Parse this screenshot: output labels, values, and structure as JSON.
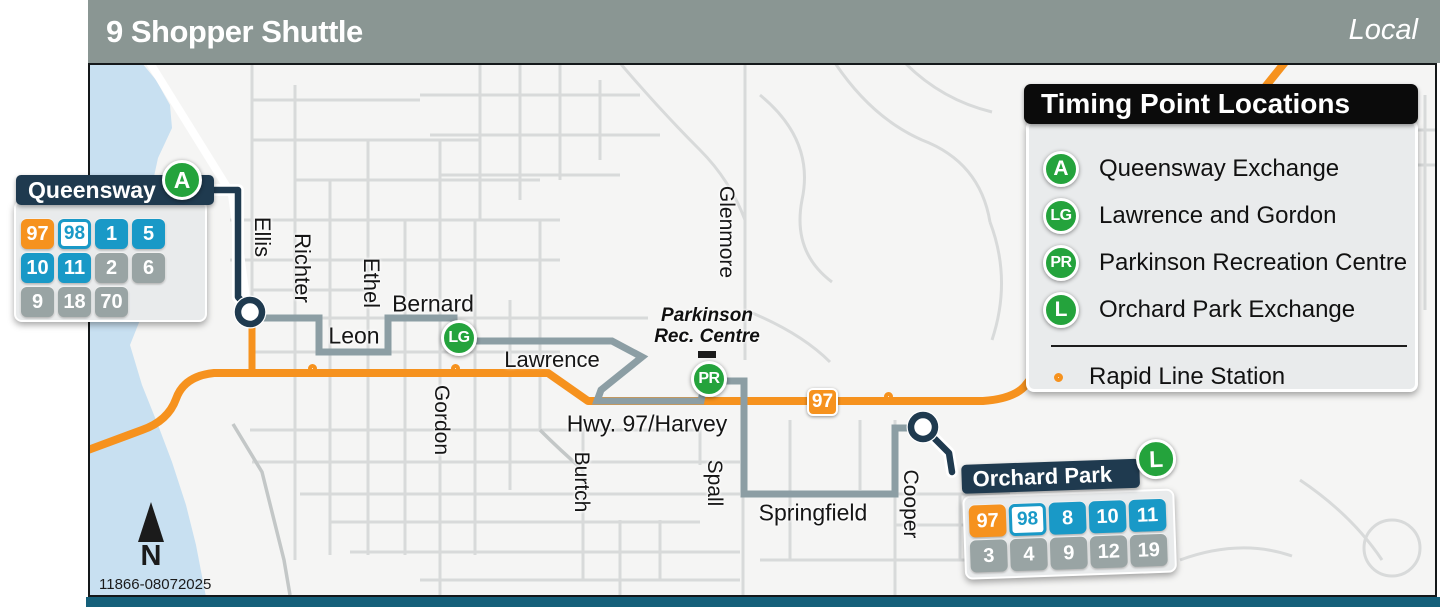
{
  "header": {
    "title": "9 Shopper Shuttle",
    "route_type": "Local"
  },
  "map": {
    "street_labels": [
      {
        "name": "Ellis",
        "x": 262,
        "y": 237,
        "vertical": true,
        "size": 22
      },
      {
        "name": "Richter",
        "x": 302,
        "y": 268,
        "vertical": true,
        "size": 22
      },
      {
        "name": "Ethel",
        "x": 371,
        "y": 283,
        "vertical": true,
        "size": 22
      },
      {
        "name": "Bernard",
        "x": 433,
        "y": 304,
        "vertical": false,
        "size": 23
      },
      {
        "name": "Leon",
        "x": 354,
        "y": 336,
        "vertical": false,
        "size": 23
      },
      {
        "name": "Lawrence",
        "x": 552,
        "y": 360,
        "vertical": false,
        "size": 22
      },
      {
        "name": "Gordon",
        "x": 441,
        "y": 420,
        "vertical": true,
        "size": 21
      },
      {
        "name": "Hwy. 97/Harvey",
        "x": 647,
        "y": 424,
        "vertical": false,
        "size": 23
      },
      {
        "name": "Burtch",
        "x": 581,
        "y": 482,
        "vertical": true,
        "size": 21
      },
      {
        "name": "Spall",
        "x": 714,
        "y": 483,
        "vertical": true,
        "size": 21
      },
      {
        "name": "Glenmore",
        "x": 726,
        "y": 232,
        "vertical": true,
        "size": 21
      },
      {
        "name": "Springfield",
        "x": 813,
        "y": 513,
        "vertical": false,
        "size": 23
      },
      {
        "name": "Cooper",
        "x": 910,
        "y": 504,
        "vertical": true,
        "size": 21
      }
    ],
    "poi": {
      "line1": "Parkinson",
      "line2": "Rec. Centre"
    },
    "timing_points": [
      {
        "code": "LG",
        "x": 459,
        "y": 338
      },
      {
        "code": "PR",
        "x": 709,
        "y": 379
      }
    ],
    "rapid_stations": [
      {
        "x": 317,
        "y": 373
      },
      {
        "x": 460,
        "y": 373
      },
      {
        "x": 893,
        "y": 401
      }
    ],
    "highway_badge": "97",
    "plate_number": "11866-08072025",
    "north_label": "N"
  },
  "queensway": {
    "title": "Queensway",
    "timing_code": "A",
    "badge_rows": [
      [
        {
          "label": "97",
          "style": "rapid"
        },
        {
          "label": "98",
          "style": "outline"
        },
        {
          "label": "1",
          "style": "frequent"
        },
        {
          "label": "5",
          "style": "frequent"
        }
      ],
      [
        {
          "label": "10",
          "style": "frequent"
        },
        {
          "label": "11",
          "style": "frequent"
        },
        {
          "label": "2",
          "style": "local"
        },
        {
          "label": "6",
          "style": "local"
        }
      ],
      [
        {
          "label": "9",
          "style": "local"
        },
        {
          "label": "18",
          "style": "local"
        },
        {
          "label": "70",
          "style": "local"
        }
      ]
    ]
  },
  "orchard_park": {
    "title": "Orchard Park",
    "timing_code": "L",
    "badge_rows": [
      [
        {
          "label": "97",
          "style": "rapid"
        },
        {
          "label": "98",
          "style": "outline"
        },
        {
          "label": "8",
          "style": "frequent"
        },
        {
          "label": "10",
          "style": "frequent"
        },
        {
          "label": "11",
          "style": "frequent"
        }
      ],
      [
        {
          "label": "3",
          "style": "local"
        },
        {
          "label": "4",
          "style": "local"
        },
        {
          "label": "9",
          "style": "local"
        },
        {
          "label": "12",
          "style": "local"
        },
        {
          "label": "19",
          "style": "local"
        }
      ]
    ]
  },
  "legend": {
    "title": "Timing Point Locations",
    "items": [
      {
        "code": "A",
        "label": "Queensway Exchange"
      },
      {
        "code": "LG",
        "label": "Lawrence and Gordon"
      },
      {
        "code": "PR",
        "label": "Parkinson Recreation Centre"
      },
      {
        "code": "L",
        "label": "Orchard Park Exchange"
      }
    ],
    "station_label": "Rapid Line Station"
  },
  "colors": {
    "rapid_orange": "#F6921E",
    "shuttle_route_gray": "#8C9EA4",
    "timing_point_green": "#24A33C",
    "callout_navy": "#1F3A4F",
    "frequent_blue": "#1999C7",
    "local_gray": "#99A4A4",
    "water_blue": "#C8E0F1",
    "header_gray": "#8A9693"
  }
}
